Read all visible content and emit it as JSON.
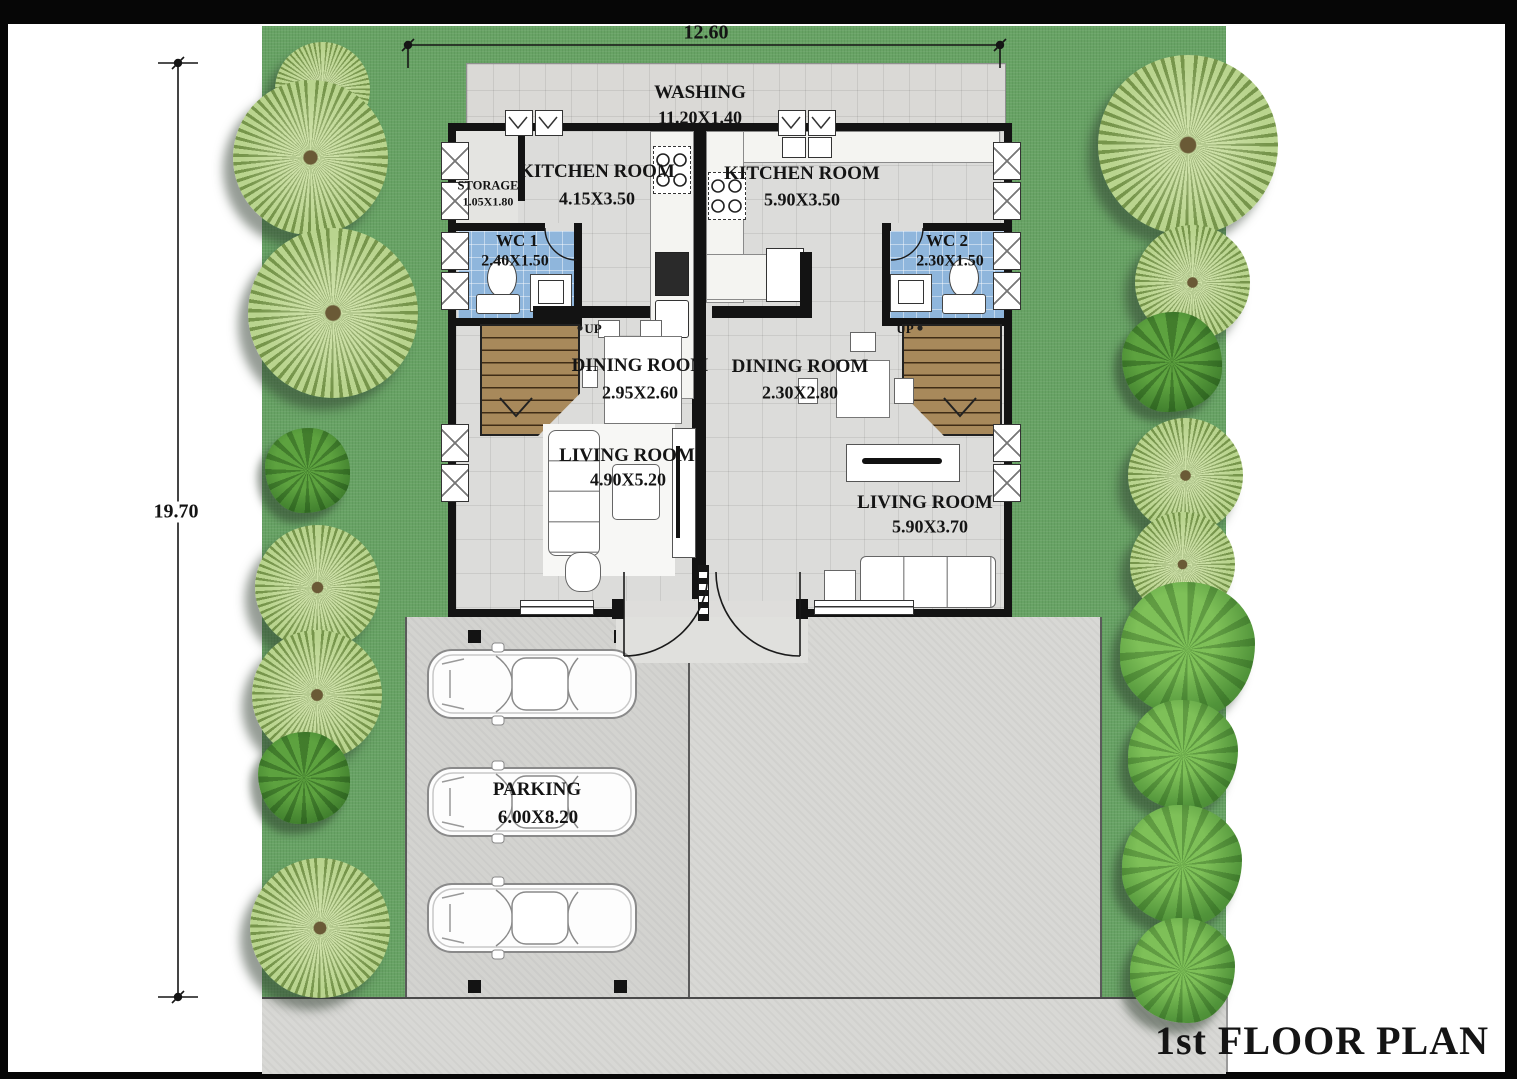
{
  "title": "1st FLOOR PLAN",
  "dimensions": {
    "top_width": "12.60",
    "left_height": "19.70"
  },
  "rooms": {
    "washing": {
      "name": "WASHING",
      "size": "11.20X1.40"
    },
    "storage": {
      "name": "STORAGE",
      "size": "1.05X1.80"
    },
    "kitchen_left": {
      "name": "KITCHEN ROOM",
      "size": "4.15X3.50"
    },
    "kitchen_right": {
      "name": "KITCHEN ROOM",
      "size": "5.90X3.50"
    },
    "wc1": {
      "name": "WC 1",
      "size": "2.40X1.50"
    },
    "wc2": {
      "name": "WC 2",
      "size": "2.30X1.50"
    },
    "dining_left": {
      "name": "DINING ROOM",
      "size": "2.95X2.60"
    },
    "dining_right": {
      "name": "DINING ROOM",
      "size": "2.30X2.80"
    },
    "living_left": {
      "name": "LIVING ROOM",
      "size": "4.90X5.20"
    },
    "living_right": {
      "name": "LIVING ROOM",
      "size": "5.90X3.70"
    },
    "parking": {
      "name": "PARKING",
      "size": "6.00X8.20"
    }
  },
  "stairs": {
    "up_left": "UP",
    "up_right": "UP"
  },
  "colors": {
    "lawn": "#68a365",
    "floor_tile": "#dcdcda",
    "wc_tile": "#8fb6dc",
    "stair_wood": "#a8895b",
    "concrete": "#d8d8d5",
    "wall": "#131313",
    "tree_palm": "#b9d48e",
    "tree_leafy": "#51943a"
  }
}
